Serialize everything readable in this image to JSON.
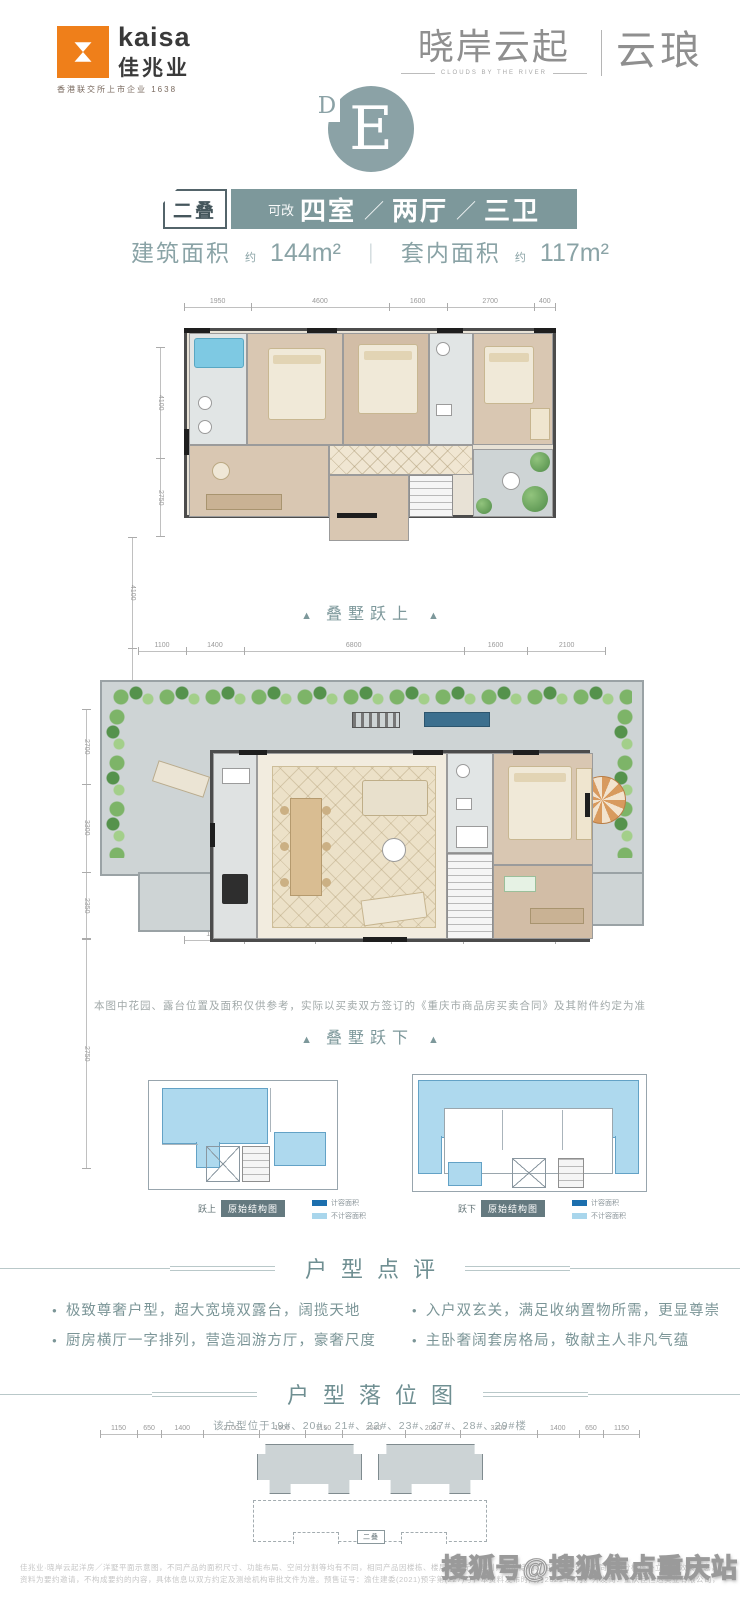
{
  "header": {
    "logo": {
      "brand_en": "kaisa",
      "brand_cn": "佳兆业",
      "tagline": "香港联交所上市企业 1638"
    },
    "project": {
      "name": "晓岸云起",
      "subtitle": "CLOUDS BY THE RIVER",
      "series": "云琅"
    }
  },
  "emblem": {
    "letter": "E",
    "sub_letter": "D"
  },
  "spec": {
    "tag": "二叠",
    "prefix": "可改",
    "rooms": [
      "四室",
      "两厅",
      "三卫"
    ],
    "separator": "／"
  },
  "area": {
    "items": [
      {
        "label": "建筑面积",
        "approx": "约",
        "value": "144m²"
      },
      {
        "label": "套内面积",
        "approx": "约",
        "value": "117m²"
      }
    ],
    "divider": "｜"
  },
  "plan_upper": {
    "caption_text": "叠墅跃上",
    "caption_arrow": "▲",
    "dims_top": [
      "1950",
      "4600",
      "1600",
      "2700",
      "400"
    ],
    "dims_bottom": [
      "1850",
      "2300",
      "2500",
      "2350",
      "3200"
    ],
    "dims_left": [
      "4100",
      "2750"
    ],
    "dims_right": [
      "4100",
      "2750"
    ]
  },
  "plan_lower": {
    "caption_text": "叠墅跃下",
    "caption_arrow": "▲",
    "dims_top": [
      "1100",
      "1400",
      "6800",
      "1600",
      "2100"
    ],
    "dims_bottom": [
      "1150",
      "650",
      "1400",
      "2100",
      "1600",
      "1150",
      "2500",
      "2050",
      "3200",
      "1400",
      "650",
      "1150"
    ],
    "dims_left": [
      "2700",
      "3300",
      "2350"
    ],
    "dims_right": [
      "2750"
    ],
    "disclaimer": "本图中花园、露台位置及面积仅供参考，实际以买卖双方签订的《重庆市商品房买卖合同》及其附件约定为准"
  },
  "structure": {
    "left": {
      "prefix": "跃上",
      "badge": "原始结构图"
    },
    "right": {
      "prefix": "跃下",
      "badge": "原始结构图"
    },
    "legend": [
      {
        "color": "#1c6fae",
        "label": "计容面积"
      },
      {
        "color": "#a9d6ec",
        "label": "不计容面积"
      }
    ]
  },
  "review": {
    "title": "户型点评",
    "bullets_left": [
      "极致尊奢户型，超大宽境双露台，阔揽天地",
      "厨房横厅一字排列，营造洄游方厅，豪奢尺度"
    ],
    "bullets_right": [
      "入户双玄关，满足收纳置物所需，更显尊崇",
      "主卧奢阔套房格局，敬献主人非凡气蕴"
    ]
  },
  "location": {
    "title": "户型落位图",
    "subtitle": "该户型位于19#、20#、21#、22#、23#、27#、28#、29#楼",
    "marker": "二叠"
  },
  "footer": {
    "line1": "佳兆业·晓岸云起洋房／洋墅平面示意图，不同产品的面积尺寸、功能布局、空间分割等均有不同，相同产品因楼栋、楼层、单元等差别，局部结构、面积等也可能不同，部分楼栋外立面为效果示意，立面不可销售，具体以政府最终审批图纸和实际交付标准为准。本宣传",
    "line2": "资料为要约邀请，不构成要约的内容，具体信息以双方约定及测绘机构审批文件为准。预售证号：渝住建委(2021)预字第(227)号，本资料发布时间为2021年4月。开发商：重庆佳恒达实业有限公司，本公司保留对宣传资料的最终解释权。",
    "watermark": "搜狐号@搜狐焦点重庆站"
  },
  "colors": {
    "accent_teal": "#7d989b",
    "emblem": "#8ba2a6",
    "logo_orange": "#ef7f1a",
    "structure_blue_dark": "#1c6fae",
    "structure_blue_light": "#a9d6ec"
  }
}
